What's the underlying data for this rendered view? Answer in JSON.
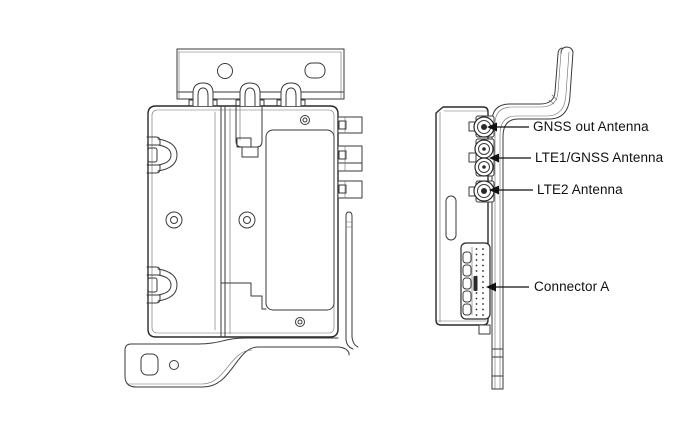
{
  "figure": {
    "kind": "hardware-connector-location-diagram",
    "background": "#ffffff",
    "ink": "#2a2a2a",
    "line_color": "#3a3a3a"
  },
  "callouts": [
    {
      "id": "gnss-out-antenna",
      "label": "GNSS out Antenna"
    },
    {
      "id": "lte1-gnss-antenna",
      "label": "LTE1/GNSS Antenna"
    },
    {
      "id": "lte2-antenna",
      "label": "LTE2 Antenna"
    },
    {
      "id": "connector-a",
      "label": "Connector A"
    }
  ]
}
